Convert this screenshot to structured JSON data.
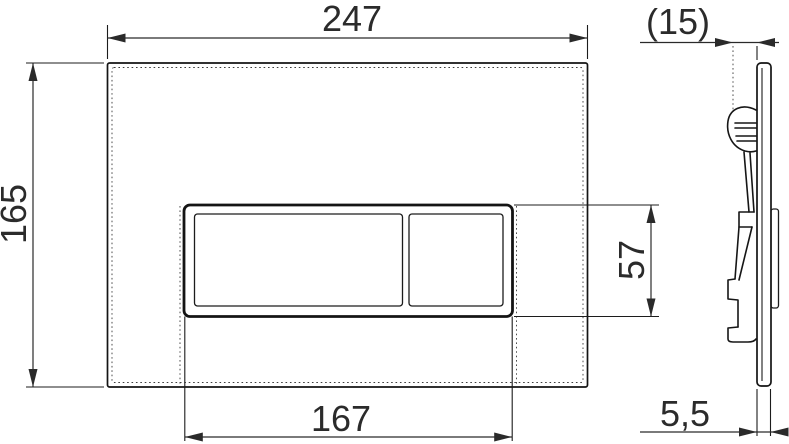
{
  "meta": {
    "drawing_type": "flush-plate-technical-drawing",
    "background_color": "#ffffff",
    "line_color": "#1c1c1c",
    "text_color": "#2b2b2b"
  },
  "dimensions": {
    "overall_width": "247",
    "overall_height": "165",
    "buttons_width": "167",
    "buttons_height": "57",
    "depth_reference": "(15)",
    "plate_thickness": "5,5"
  }
}
